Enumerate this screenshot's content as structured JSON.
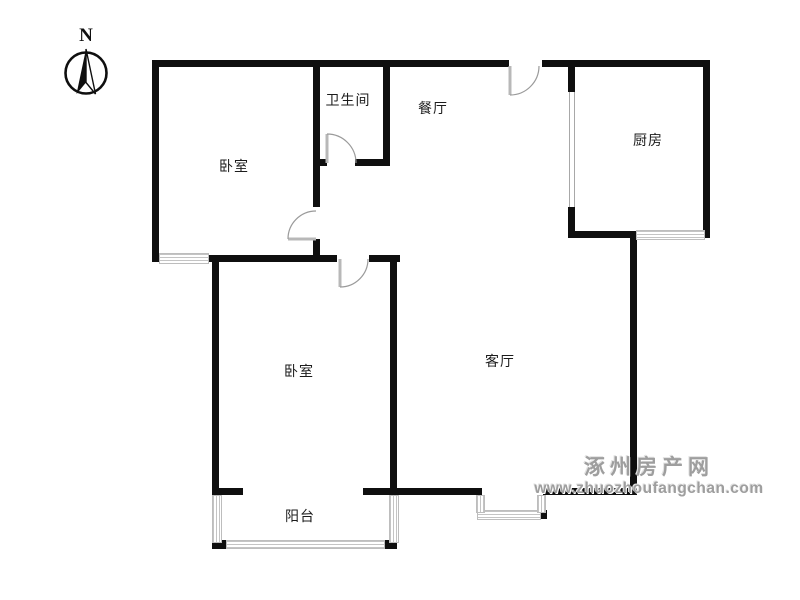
{
  "compass": {
    "label": "N"
  },
  "rooms": [
    {
      "name": "bedroom-north",
      "label": "卧室"
    },
    {
      "name": "bathroom",
      "label": "卫生间"
    },
    {
      "name": "dining-room",
      "label": "餐厅"
    },
    {
      "name": "kitchen",
      "label": "厨房"
    },
    {
      "name": "bedroom-south",
      "label": "卧室"
    },
    {
      "name": "living-room",
      "label": "客厅"
    },
    {
      "name": "balcony",
      "label": "阳台"
    }
  ],
  "watermark": {
    "site_name": "涿州房产网",
    "site_url": "www.zhuozhoufangchan.com"
  },
  "colors": {
    "wall": "#0f0f0f",
    "door": "#9a9a9a",
    "window_hatch": "#c4c4c4",
    "watermark_gray": "#9e9e9e"
  },
  "elements": {
    "doors": [
      "entry-door",
      "bathroom-door",
      "bedroom-north-door",
      "bedroom-south-door",
      "kitchen-sliding-door"
    ],
    "windows": [
      "bedroom-north-window",
      "kitchen-window",
      "living-room-bay-window",
      "balcony-glazing"
    ]
  }
}
